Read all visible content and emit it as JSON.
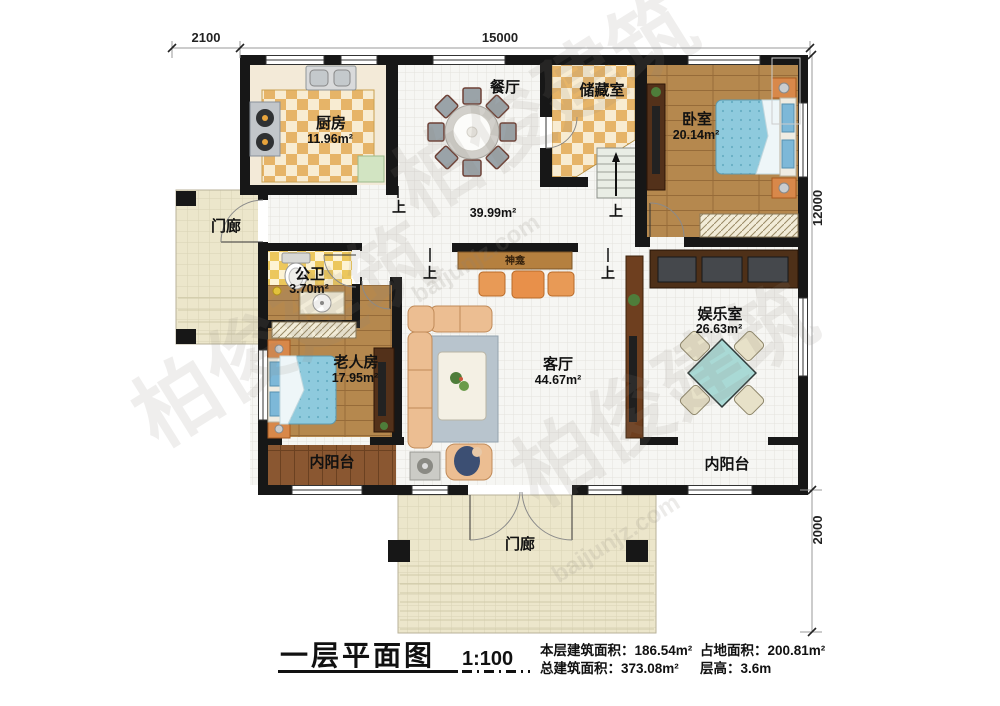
{
  "title_block": {
    "title": "一层平面图",
    "scale": "1:100",
    "stats": [
      {
        "label": "本层建筑面积：",
        "value": "186.54m²"
      },
      {
        "label": "占地面积：",
        "value": "200.81m²"
      },
      {
        "label": "总建筑面积：",
        "value": "373.08m²"
      },
      {
        "label": "层高：",
        "value": "3.6m"
      }
    ]
  },
  "dimensions": {
    "top_offset": "2100",
    "top_width": "15000",
    "right_height": "12000",
    "porch_depth": "2000"
  },
  "rooms": {
    "kitchen": {
      "name": "厨房",
      "area": "11.96m²"
    },
    "dining": {
      "name": "餐厅"
    },
    "hall": {
      "area": "39.99m²"
    },
    "storage": {
      "name": "储藏室"
    },
    "bedroom": {
      "name": "卧室",
      "area": "20.14m²"
    },
    "porch_left": {
      "name": "门廊"
    },
    "bathroom": {
      "name": "公卫",
      "area": "3.70m²"
    },
    "elder_room": {
      "name": "老人房",
      "area": "17.95m²"
    },
    "living": {
      "name": "客厅",
      "area": "44.67m²"
    },
    "entertainment": {
      "name": "娱乐室",
      "area": "26.63m²"
    },
    "balcony_left": {
      "name": "内阳台"
    },
    "balcony_right": {
      "name": "内阳台"
    },
    "porch_bottom": {
      "name": "门廊"
    }
  },
  "annotations": {
    "up": "上",
    "shrine": "神龛"
  },
  "watermark": {
    "cn": "柏俊建筑",
    "en": "baijunjz.com"
  }
}
